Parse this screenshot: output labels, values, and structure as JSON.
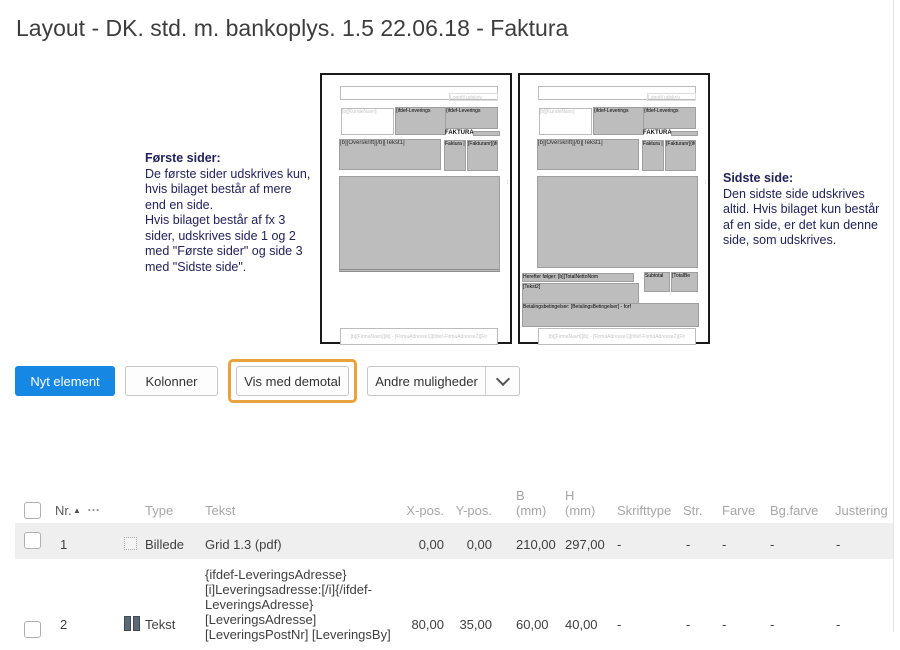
{
  "title": "Layout - DK. std. m. bankoplys. 1.5 22.06.18 - Faktura",
  "info": {
    "first": {
      "heading": "Første sider:",
      "body": "De første sider udskrives kun,\nhvis bilaget består af mere\nend en side.\nHvis bilaget består af fx 3\nsider, udskrives side 1 og 2\nmed \"Første sider\" og side 3\nmed \"Sidste side\"."
    },
    "last": {
      "heading": "Sidste side:",
      "body": "Den sidste side udskrives\naltid. Hvis bilaget kun består\naf en side, er det kun denne\nside, som udskrives."
    }
  },
  "thumbs": {
    "logo_hint": "Logofil udskriv",
    "kunde": "[b][KundeNavn]",
    "ifdef_leverings": "{ifdef-Leverings",
    "faktura_heading": "FAKTURA",
    "overskrift": "[b][Overskrift][/b][Tekst1]",
    "faktura_cell": "Faktura |",
    "fakturanr_cell": "[Fakturanr]{ifd",
    "dots": "⋮",
    "herefter": "Herefter følger: [b][TotalNettoNom",
    "tekst2": "[Tekst2]",
    "subtotal": "Subtotal",
    "totalbe": "[TotalBe",
    "betaling": "Betalingsbetingelser: [BetalingsBetingelser] - forf",
    "footer": "[b][FirmaNavn][/b] - [FirmaAdresse1]{ifdef-FirmaAdresse2}[Fir"
  },
  "toolbar": {
    "new_element": "Nyt element",
    "columns": "Kolonner",
    "demo": "Vis med demotal",
    "more": "Andre muligheder"
  },
  "table": {
    "headers": {
      "nr": "Nr.",
      "sort": "▲",
      "menu": "…",
      "type": "Type",
      "tekst": "Tekst",
      "xpos": "X-pos.",
      "ypos": "Y-pos.",
      "b": "B",
      "b_unit": "(mm)",
      "h": "H",
      "h_unit": "(mm)",
      "font": "Skrifttype",
      "size": "Str.",
      "color": "Farve",
      "bgcolor": "Bg.farve",
      "align": "Justering"
    },
    "rows": [
      {
        "nr": "1",
        "type": "Billede",
        "tekst": "Grid 1.3 (pdf)",
        "xpos": "0,00",
        "ypos": "0,00",
        "b": "210,00",
        "h": "297,00",
        "font": "-",
        "size": "-",
        "color": "-",
        "bgcolor": "-",
        "align": "-"
      },
      {
        "nr": "2",
        "type": "Tekst",
        "tekst": "{ifdef-LeveringsAdresse}\n[i]Leveringsadresse:[/i]{/ifdef-\nLeveringsAdresse}\n[LeveringsAdresse]\n[LeveringsPostNr] [LeveringsBy]",
        "xpos": "80,00",
        "ypos": "35,00",
        "b": "60,00",
        "h": "40,00",
        "font": "-",
        "size": "-",
        "color": "-",
        "bgcolor": "-",
        "align": "-"
      }
    ]
  },
  "colors": {
    "primary_button": "#1687e3",
    "highlight": "#e8a33c"
  }
}
